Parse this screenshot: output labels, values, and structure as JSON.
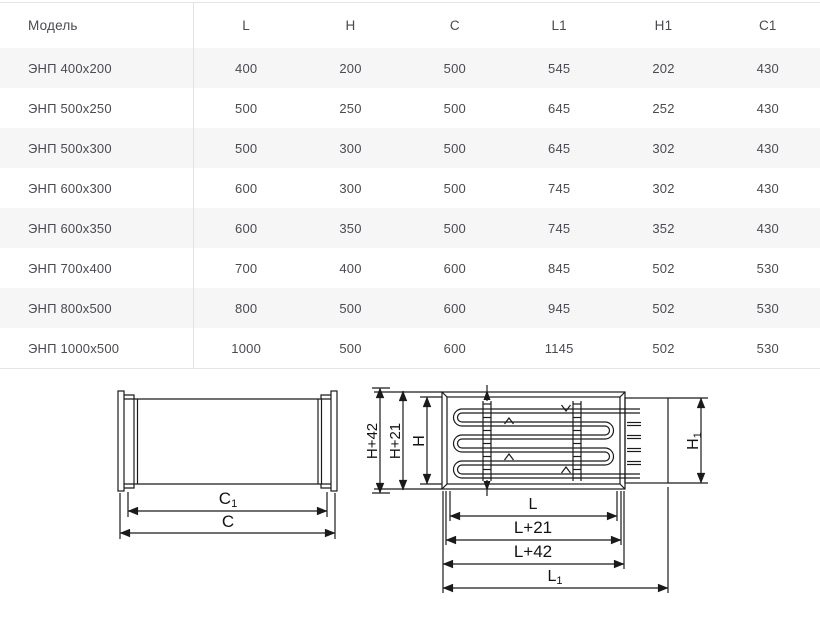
{
  "colors": {
    "background": "#ffffff",
    "stripe": "#f6f6f7",
    "table_border": "#e6e6e9",
    "table_text": "#4a4a51",
    "drawing_line": "#1a1a1a"
  },
  "table": {
    "headers": [
      "Модель",
      "L",
      "H",
      "C",
      "L1",
      "H1",
      "C1"
    ],
    "rows": [
      [
        "ЭНП 400х200",
        "400",
        "200",
        "500",
        "545",
        "202",
        "430"
      ],
      [
        "ЭНП 500х250",
        "500",
        "250",
        "500",
        "645",
        "252",
        "430"
      ],
      [
        "ЭНП 500х300",
        "500",
        "300",
        "500",
        "645",
        "302",
        "430"
      ],
      [
        "ЭНП 600х300",
        "600",
        "300",
        "500",
        "745",
        "302",
        "430"
      ],
      [
        "ЭНП 600х350",
        "600",
        "350",
        "500",
        "745",
        "352",
        "430"
      ],
      [
        "ЭНП 700х400",
        "700",
        "400",
        "600",
        "845",
        "502",
        "530"
      ],
      [
        "ЭНП 800х500",
        "800",
        "500",
        "600",
        "945",
        "502",
        "530"
      ],
      [
        "ЭНП 1000х500",
        "1000",
        "500",
        "600",
        "1145",
        "502",
        "530"
      ]
    ]
  },
  "diagram": {
    "side_view": {
      "c1": {
        "base": "C",
        "sub": "1"
      },
      "c": "C"
    },
    "front_view": {
      "h_plus_42": "H+42",
      "h_plus_21": "H+21",
      "h": "H",
      "h1": {
        "base": "H",
        "sub": "1"
      },
      "l": "L",
      "l_plus_21": "L+21",
      "l_plus_42": "L+42",
      "l1": {
        "base": "L",
        "sub": "1"
      }
    }
  }
}
